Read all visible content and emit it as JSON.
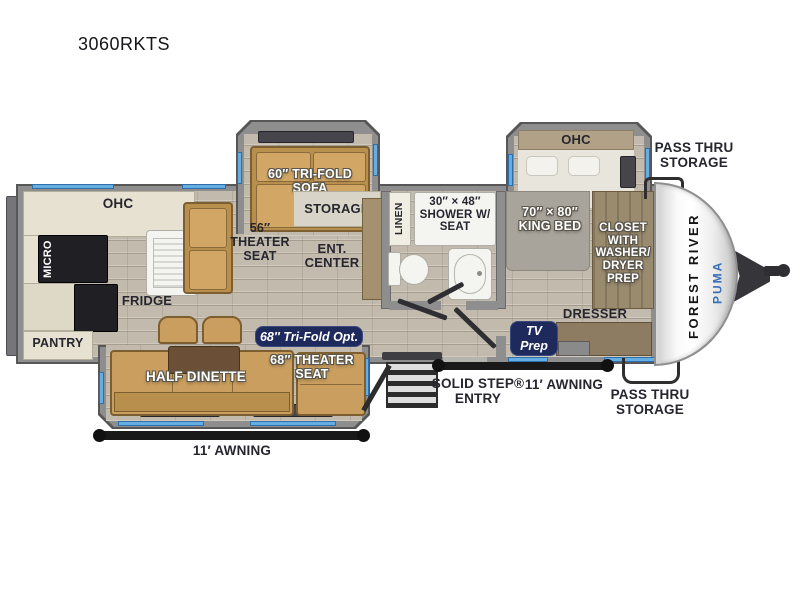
{
  "title": "3060RKTS",
  "front_cap": {
    "maker": "FOREST RIVER",
    "model": "PUMA"
  },
  "badges": {
    "tv_prep": "TV\nPrep",
    "tri_fold_opt": "68″ Tri-Fold Opt."
  },
  "labels": {
    "sofa": "60″ TRI-FOLD\nSOFA",
    "storage": "STORAGE",
    "ohc_kitchen": "OHC",
    "micro": "MICRO",
    "fridge": "FRIDGE",
    "pantry": "PANTRY",
    "theater_seat_56": "56″\nTHEATER\nSEAT",
    "ent_center": "ENT.\nCENTER",
    "linen": "LINEN",
    "shower": "30″ × 48″\nSHOWER W/\nSEAT",
    "ohc_bedroom": "OHC",
    "king_bed": "70″ × 80″\nKING BED",
    "closet": "CLOSET\nWITH\nWASHER/\nDRYER\nPREP",
    "dresser": "DRESSER",
    "half_dinette": "HALF DINETTE",
    "theater_seat_68": "68″ THEATER\nSEAT",
    "pass_thru_top": "PASS THRU\nSTORAGE",
    "pass_thru_bottom": "PASS THRU\nSTORAGE",
    "solid_step_entry": "SOLID STEP®\nENTRY",
    "awning_door_side": "11′ AWNING",
    "awning_camp_side": "11′ AWNING"
  },
  "colors": {
    "window_blue": "#64aee4",
    "badge_navy": "#1e2a5c",
    "furniture_tan": "#c99e5e",
    "wall_gray": "#8e8e8e",
    "puma_blue": "#3a6fb5",
    "floor_tan": "#c2baac"
  }
}
